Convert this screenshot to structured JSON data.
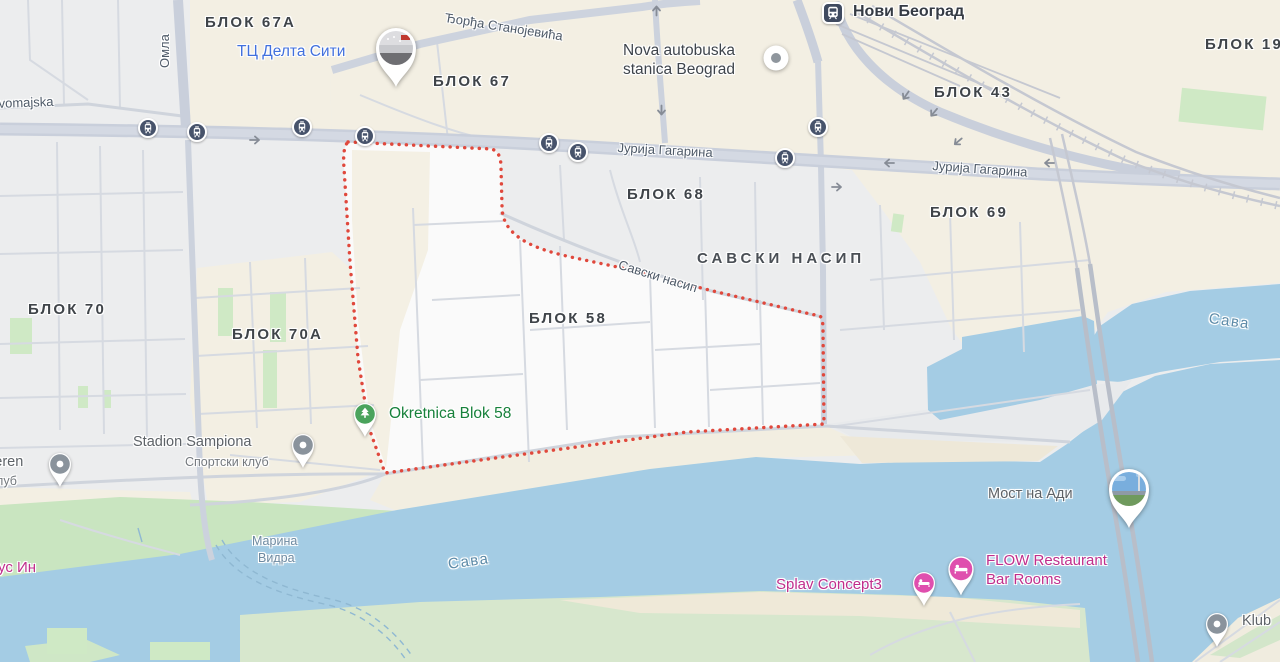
{
  "map": {
    "palette": {
      "water": "#a4cce4",
      "boundary_red": "#e0483c",
      "beige": "#f3efe3",
      "urban_gray": "#ecedee",
      "green": "#c9e5c0",
      "road": "#c9cfdb",
      "poi_pink_text": "#c02e8c",
      "pin_pink": "#df4fae",
      "poi_green_text": "#17813b",
      "pin_green": "#4aa35c",
      "poi_blue_text": "#4170dd",
      "label_dark": "#3f4449",
      "gray_pin": "#8a939c",
      "transit_icon": "#3f4a5f"
    },
    "labels": [
      {
        "name": "label-blok-67a",
        "text": "БЛОК 67А",
        "x": 205,
        "y": 14,
        "cls": "block",
        "inter": false
      },
      {
        "name": "label-blok-67",
        "text": "БЛОК 67",
        "x": 433,
        "y": 73,
        "cls": "block",
        "inter": false
      },
      {
        "name": "label-blok-43",
        "text": "БЛОК 43",
        "x": 934,
        "y": 84,
        "cls": "block",
        "inter": false
      },
      {
        "name": "label-blok-19",
        "text": "БЛОК 19",
        "x": 1205,
        "y": 36,
        "cls": "block",
        "inter": false
      },
      {
        "name": "label-blok-68",
        "text": "БЛОК 68",
        "x": 627,
        "y": 186,
        "cls": "block",
        "inter": false
      },
      {
        "name": "label-blok-69",
        "text": "БЛОК 69",
        "x": 930,
        "y": 204,
        "cls": "block",
        "inter": false
      },
      {
        "name": "label-blok-70",
        "text": "БЛОК 70",
        "x": 28,
        "y": 301,
        "cls": "block",
        "inter": false
      },
      {
        "name": "label-blok-70a",
        "text": "БЛОК 70А",
        "x": 232,
        "y": 326,
        "cls": "block",
        "inter": false
      },
      {
        "name": "label-blok-58",
        "text": "БЛОК 58",
        "x": 529,
        "y": 310,
        "cls": "block",
        "inter": false
      },
      {
        "name": "label-savski-nasip-area",
        "text": "САВСКИ НАСИП",
        "x": 697,
        "y": 250,
        "cls": "area",
        "inter": false
      },
      {
        "name": "street-djordja-stanojevica",
        "text": "Ђорђа Станојевића",
        "x": 446,
        "y": 10,
        "cls": "street",
        "rot": 9,
        "inter": false
      },
      {
        "name": "street-jurija-gagarina-1",
        "text": "Јурија Гагарина",
        "x": 618,
        "y": 140,
        "cls": "street",
        "rot": 3,
        "inter": false
      },
      {
        "name": "street-jurija-gagarina-2",
        "text": "Јурија Гагарина",
        "x": 933,
        "y": 158,
        "cls": "street",
        "rot": 4,
        "inter": false
      },
      {
        "name": "street-savski-nasip",
        "text": "Савски насип",
        "x": 621,
        "y": 257,
        "cls": "street",
        "rot": 17,
        "inter": false
      },
      {
        "name": "street-omladinskih",
        "text": "Омла",
        "x": 157,
        "y": 68,
        "cls": "street",
        "rot": -90,
        "inter": false
      },
      {
        "name": "street-prvomajska",
        "text": "rvomajska",
        "x": -6,
        "y": 96,
        "cls": "street",
        "rot": -2,
        "inter": false
      },
      {
        "name": "water-sava-main",
        "text": "Сава",
        "x": 447,
        "y": 556,
        "cls": "water-lbl",
        "rot": -8,
        "inter": false
      },
      {
        "name": "water-sava-arm",
        "text": "Сава",
        "x": 1210,
        "y": 310,
        "cls": "water-lbl",
        "rot": 8,
        "inter": false
      },
      {
        "name": "water-marina-vidra-1",
        "text": "Марина",
        "x": 252,
        "y": 534,
        "cls": "water-sm",
        "inter": false
      },
      {
        "name": "water-marina-vidra-2",
        "text": "Видра",
        "x": 258,
        "y": 551,
        "cls": "water-sm",
        "inter": false
      },
      {
        "name": "poi-delta-city",
        "text": "ТЦ Делта Сити",
        "x": 237,
        "y": 43,
        "cls": "poi-blue",
        "inter": true
      },
      {
        "name": "poi-bus-station-line1",
        "text": "Nova autobuska",
        "x": 623,
        "y": 42,
        "cls": "poi-dark",
        "inter": true
      },
      {
        "name": "poi-bus-station-line2",
        "text": "stanica Beograd",
        "x": 623,
        "y": 61,
        "cls": "poi-dark",
        "inter": true
      },
      {
        "name": "poi-novi-beograd-station",
        "text": "Нови Београд",
        "x": 853,
        "y": 3,
        "cls": "transit",
        "inter": true
      },
      {
        "name": "poi-okretnica-blok-58",
        "text": "Okretnica Blok 58",
        "x": 389,
        "y": 405,
        "cls": "poi-green",
        "inter": true
      },
      {
        "name": "poi-stadion-sampiona",
        "text": "Stadion Sampiona",
        "x": 133,
        "y": 434,
        "cls": "poi-gray",
        "inter": true
      },
      {
        "name": "poi-stadion-sub",
        "text": "Спортски клуб",
        "x": 185,
        "y": 455,
        "cls": "poi-sub",
        "inter": false
      },
      {
        "name": "poi-teren",
        "text": "Teren",
        "x": -13,
        "y": 454,
        "cls": "poi-gray",
        "inter": true
      },
      {
        "name": "poi-teren-sub",
        "text": "а клуб",
        "x": -20,
        "y": 474,
        "cls": "poi-sub",
        "inter": false
      },
      {
        "name": "poi-us-in",
        "text": "ус Ин",
        "x": -2,
        "y": 559,
        "cls": "poi-pink",
        "inter": true
      },
      {
        "name": "poi-most-na-adi",
        "text": "Мост на Ади",
        "x": 988,
        "y": 486,
        "cls": "poi-gray",
        "inter": true
      },
      {
        "name": "poi-splav-concept3",
        "text": "Splav Concept3",
        "x": 776,
        "y": 576,
        "cls": "poi-pink",
        "inter": true
      },
      {
        "name": "poi-flow-line1",
        "text": "FLOW Restaurant",
        "x": 986,
        "y": 552,
        "cls": "poi-pink",
        "inter": true
      },
      {
        "name": "poi-flow-line2",
        "text": "Bar Rooms",
        "x": 986,
        "y": 571,
        "cls": "poi-pink",
        "inter": true
      },
      {
        "name": "poi-klub",
        "text": "Klub",
        "x": 1242,
        "y": 613,
        "cls": "poi-gray",
        "inter": true
      }
    ],
    "markers": [
      {
        "name": "bus-stop-icon",
        "type": "bus",
        "x": 148,
        "y": 128
      },
      {
        "name": "bus-stop-icon",
        "type": "bus",
        "x": 197,
        "y": 132
      },
      {
        "name": "bus-stop-icon",
        "type": "bus",
        "x": 302,
        "y": 127
      },
      {
        "name": "bus-stop-icon",
        "type": "bus",
        "x": 365,
        "y": 136
      },
      {
        "name": "bus-stop-icon",
        "type": "bus",
        "x": 549,
        "y": 143
      },
      {
        "name": "bus-stop-icon",
        "type": "bus",
        "x": 578,
        "y": 152
      },
      {
        "name": "bus-stop-icon",
        "type": "bus",
        "x": 785,
        "y": 158
      },
      {
        "name": "bus-stop-icon",
        "type": "bus",
        "x": 818,
        "y": 127
      },
      {
        "name": "train-station-icon",
        "type": "train",
        "x": 833,
        "y": 13
      },
      {
        "name": "bus-station-dot-icon",
        "type": "poidot",
        "x": 776,
        "y": 58
      },
      {
        "name": "delta-city-photo-pin",
        "type": "photo-mall",
        "x": 396,
        "y": 48
      },
      {
        "name": "most-na-adi-photo-pin",
        "type": "photo-bridge",
        "x": 1129,
        "y": 489
      },
      {
        "name": "stadion-pin",
        "type": "graypin",
        "x": 303,
        "y": 445
      },
      {
        "name": "teren-pin",
        "type": "graypin",
        "x": 60,
        "y": 464
      },
      {
        "name": "klub-pin",
        "type": "graypin",
        "x": 1217,
        "y": 624
      },
      {
        "name": "okretnica-tree-pin",
        "type": "treepin",
        "x": 365,
        "y": 414
      },
      {
        "name": "splav-bed-pin",
        "type": "bedpin",
        "x": 924,
        "y": 583,
        "s": 1
      },
      {
        "name": "flow-bed-pin",
        "type": "bedpin",
        "x": 963,
        "y": 571,
        "s": 1.15
      },
      {
        "name": "road-arrow",
        "type": "arrow",
        "x": 255,
        "y": 140,
        "rot": 0
      },
      {
        "name": "road-arrow",
        "type": "arrow",
        "x": 888,
        "y": 163,
        "rot": 180
      },
      {
        "name": "road-arrow",
        "type": "arrow",
        "x": 837,
        "y": 187,
        "rot": 0
      },
      {
        "name": "road-arrow",
        "type": "arrow",
        "x": 656,
        "y": 10,
        "rot": -90
      },
      {
        "name": "road-arrow",
        "type": "arrow",
        "x": 661,
        "y": 111,
        "rot": 90
      },
      {
        "name": "road-arrow",
        "type": "arrow",
        "x": 905,
        "y": 96,
        "rot": 125
      },
      {
        "name": "road-arrow",
        "type": "arrow",
        "x": 933,
        "y": 113,
        "rot": 130
      },
      {
        "name": "road-arrow",
        "type": "arrow",
        "x": 957,
        "y": 142,
        "rot": 140
      },
      {
        "name": "road-arrow",
        "type": "arrow",
        "x": 1048,
        "y": 163,
        "rot": 180
      }
    ]
  }
}
